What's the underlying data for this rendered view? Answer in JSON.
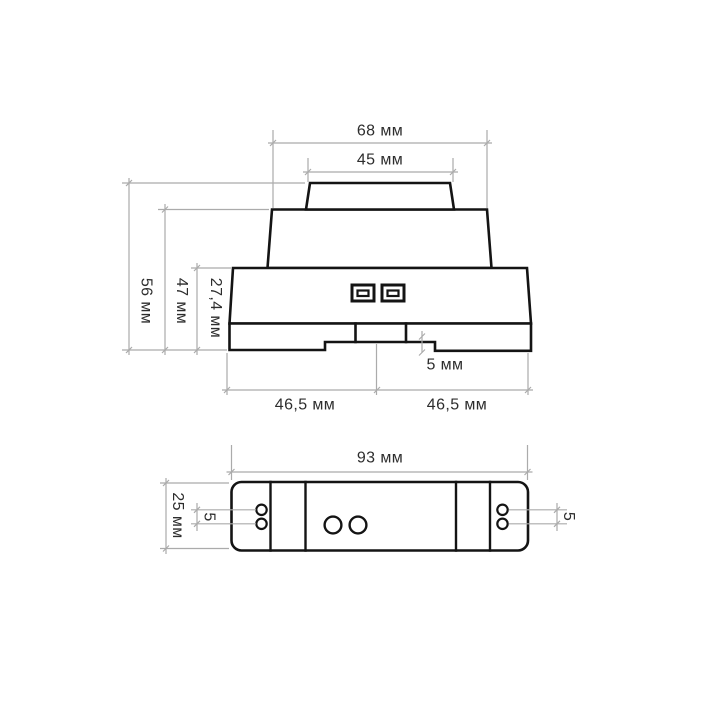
{
  "front_view": {
    "width_top": "68 мм",
    "width_cap": "45 мм",
    "height_total": "56 мм",
    "height_without_cap": "47 мм",
    "height_base": "27,4 мм",
    "notch_depth": "5 мм",
    "base_left_half": "46,5 мм",
    "base_right_half": "46,5 мм"
  },
  "top_view": {
    "length": "93 мм",
    "width": "25 мм",
    "terminal_spacing_left": "5",
    "terminal_spacing_right": "5"
  },
  "colors": {
    "outline": "#141414",
    "dimension": "#ababab",
    "text": "#2d2d2d",
    "background": "#ffffff"
  }
}
